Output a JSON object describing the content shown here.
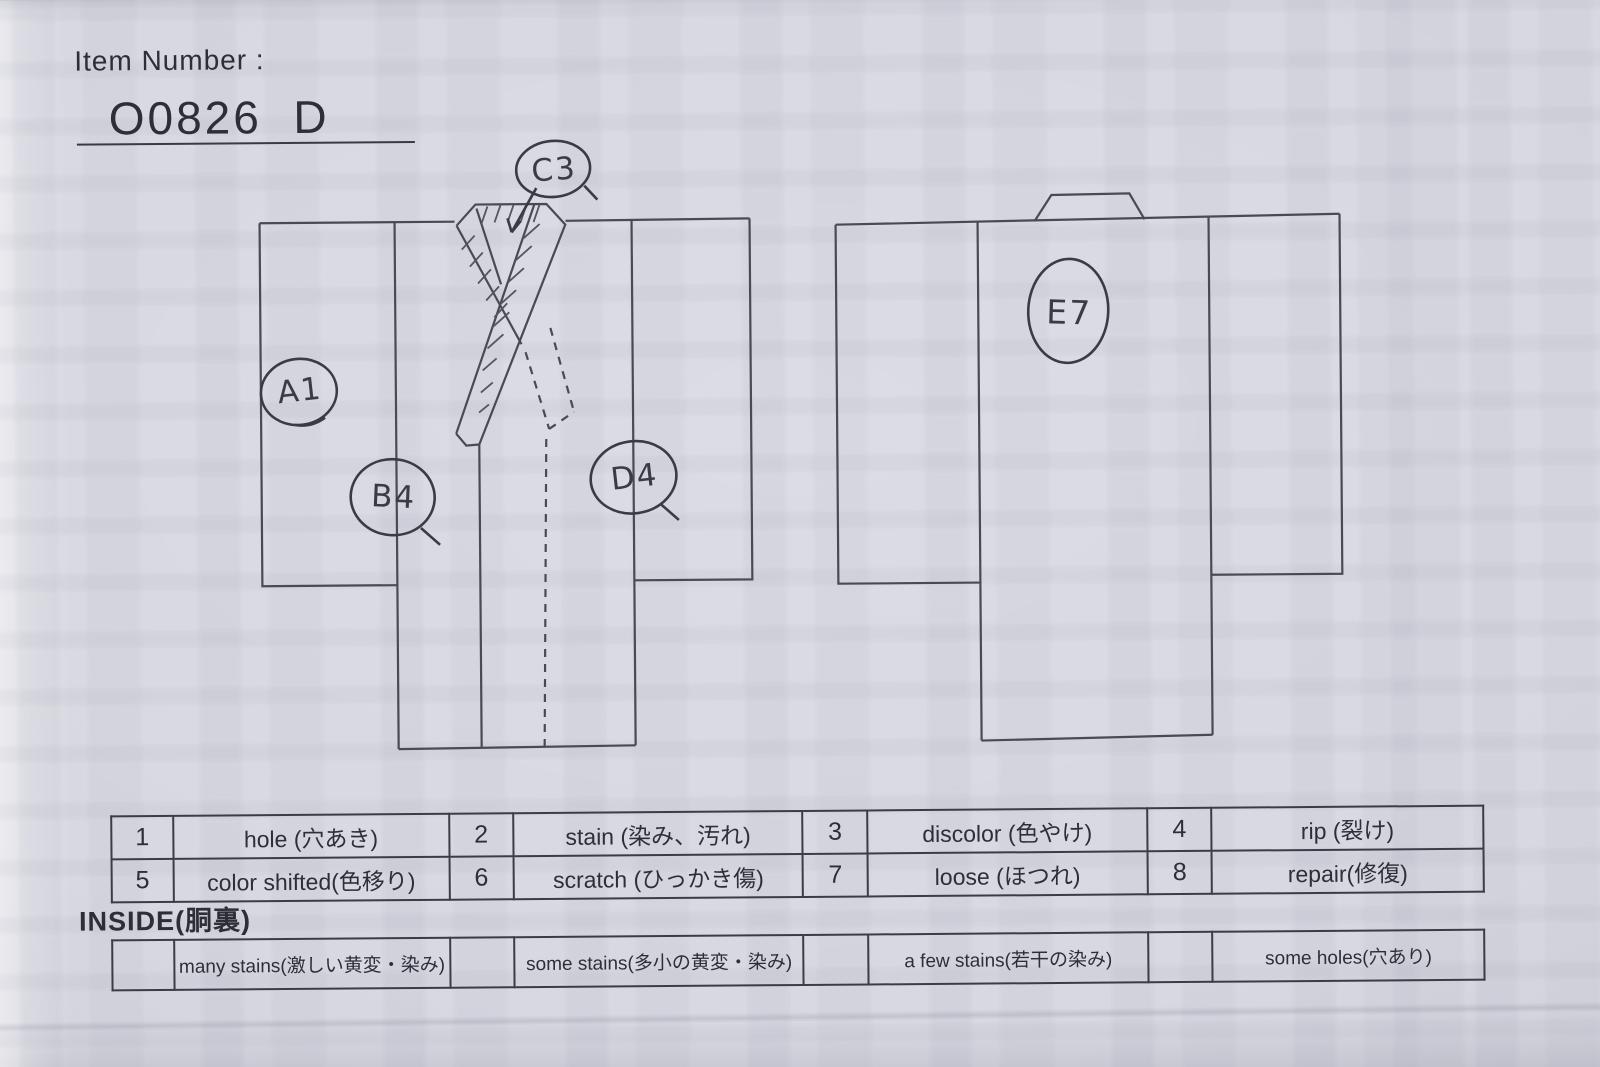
{
  "header": {
    "label": "Item Number :",
    "value": "O0826  D"
  },
  "annotations": {
    "a1": "A1",
    "b4": "B4",
    "c3": "C3",
    "d4": "D4",
    "e7": "E7"
  },
  "legend": {
    "rows": [
      [
        "1",
        "hole (穴あき)",
        "2",
        "stain (染み、汚れ)",
        "3",
        "discolor (色やけ)",
        "4",
        "rip (裂け)"
      ],
      [
        "5",
        "color shifted(色移り)",
        "6",
        "scratch (ひっかき傷)",
        "7",
        "loose (ほつれ)",
        "8",
        "repair(修復)"
      ]
    ]
  },
  "inside": {
    "title": "INSIDE(胴裏)",
    "cells": [
      "",
      "many stains(激しい黄変・染み)",
      "",
      "some stains(多小の黄変・染み)",
      "",
      "a few stains(若干の染み)",
      "",
      "some holes(穴あり)"
    ]
  },
  "colors": {
    "paper": "#d8d8e1",
    "printed_ink": "#2e2e38",
    "diagram_line": "#4a4a52",
    "handwriting": "#3b3b45"
  }
}
